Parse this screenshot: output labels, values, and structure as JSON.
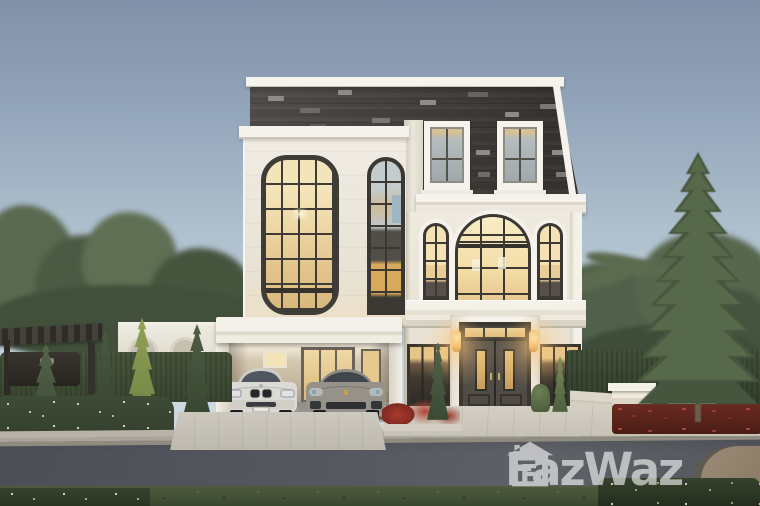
{
  "meta": {
    "type": "real-estate listing photograph",
    "subject": "Three-storey luxury detached house at dusk with dark shingle mansard roof, cream facade, black-framed arched windows glowing warm, double carport with two parked cars, clipped hedges and conifer landscaping, asphalt road in the foreground"
  },
  "watermark": {
    "brand": "FazWaz",
    "icon": "house-f-logo-icon",
    "color": "#ffffff",
    "opacity": 0.6
  },
  "scene": {
    "house": {
      "storeys": 3,
      "roof": "dark grey shingle mansard with two dormer windows",
      "walls": "cream stone with white cornices",
      "carport_cars": [
        "white sedan",
        "grey sports sedan"
      ]
    },
    "palette": {
      "sky_top": "#8191a9",
      "sky_mid": "#aebfcd",
      "sky_horizon": "#d6e1e8",
      "wall": "#eeeadf",
      "trim": "#f6f3ec",
      "roof_dark": "#45423e",
      "frame": "#3b3834",
      "glass_warm": "#eed7a4",
      "door": "#4e4a43",
      "hedge": "#333f2d",
      "foliage_mid": "#48573e",
      "road": "#4c4f55",
      "curb": "#b7b3a8",
      "pavement": "#c6c2b7",
      "flower_red": "#9c352a",
      "car_white": "#dbd9d4",
      "car_gray": "#928e88",
      "glow": "#ffc87d"
    }
  }
}
